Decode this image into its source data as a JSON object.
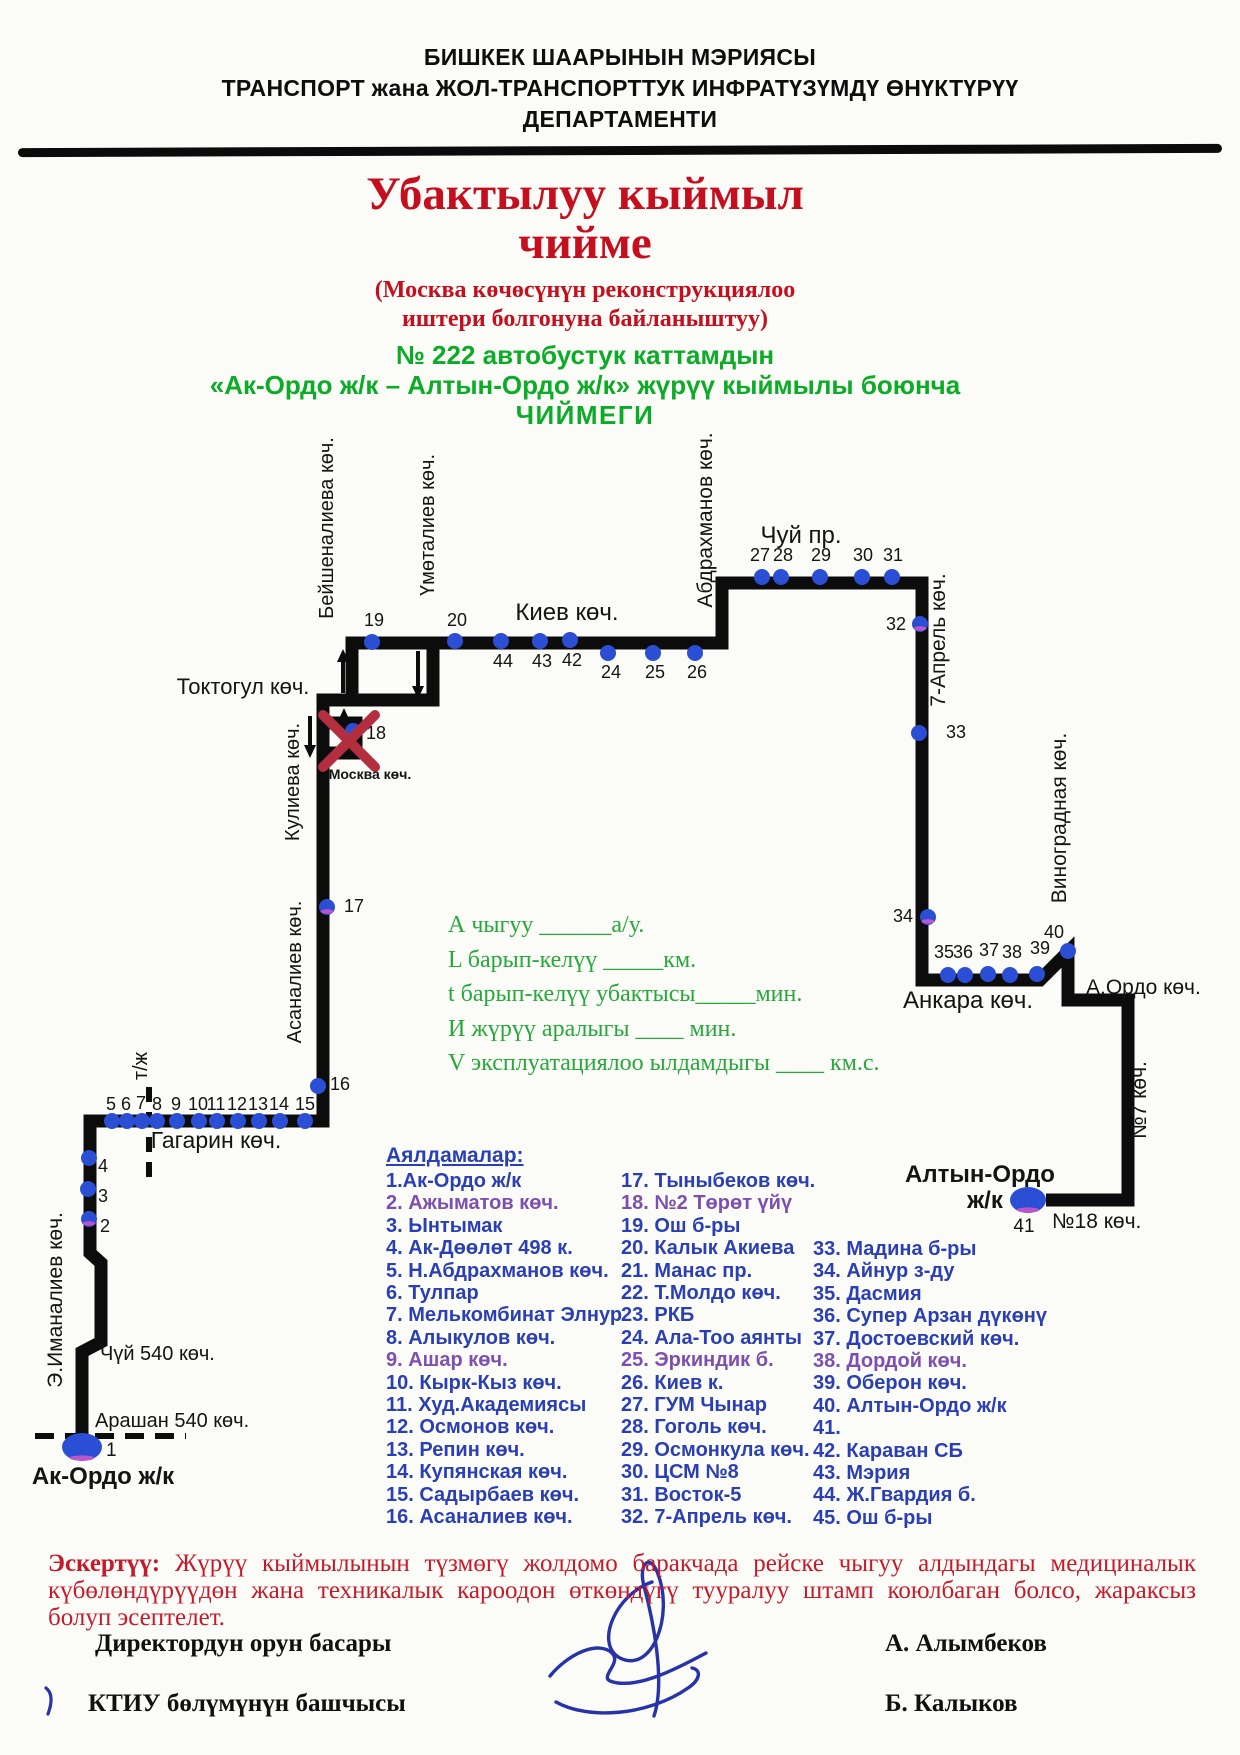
{
  "header": {
    "line1": "БИШКЕК ШААРЫНЫН МЭРИЯСЫ",
    "line2": "ТРАНСПОРТ жана ЖОЛ-ТРАНСПОРТТУК ИНФРАТҮЗҮМДҮ ӨНҮКТҮРҮҮ",
    "line3": "ДЕПАРТАМЕНТИ"
  },
  "title": {
    "line1": "Убактылуу кыймыл",
    "line2": "чийме",
    "sub1": "(Москва көчөсүнүн реконструкциялоо",
    "sub2": "иштери болгонуна байланыштуу)",
    "green1": "№ 222  автобустук каттамдын",
    "green2": "«Ак-Ордо  ж/к –  Алтын-Ордо ж/к» жүрүү кыймылы боюнча",
    "green3": "ЧИЙМЕГИ"
  },
  "params": {
    "lines": [
      "А чыгуу  ______а/у.",
      "L барып-келүү  _____км.",
      "t барып-келүү убактысы_____мин.",
      "И жүрүү аралыгы  ____   мин.",
      "V эксплуатациялоо ылдамдыгы  ____  км.с."
    ]
  },
  "stops_list": {
    "heading": "Аялдамалар:",
    "col1": [
      {
        "text": "1.Ак-Ордо ж/к"
      },
      {
        "text": "2. Ажыматов көч.",
        "tint": true
      },
      {
        "text": "3. Ынтымак"
      },
      {
        "text": "4. Ак-Дөөлөт 498 к."
      },
      {
        "text": "5. Н.Абдрахманов көч."
      },
      {
        "text": "6. Тулпар"
      },
      {
        "text": "7. Мелькомбинат Элнур"
      },
      {
        "text": "8. Алыкулов көч."
      },
      {
        "text": "9. Ашар көч.",
        "tint": true
      },
      {
        "text": "10. Кырк-Кыз көч."
      },
      {
        "text": "11. Худ.Академиясы"
      },
      {
        "text": "12. Осмонов көч."
      },
      {
        "text": "13. Репин көч."
      },
      {
        "text": "14. Купянская көч."
      },
      {
        "text": "15. Садырбаев көч."
      },
      {
        "text": "16. Асаналиев көч."
      }
    ],
    "col2": [
      {
        "text": "17. Тыныбеков көч."
      },
      {
        "text": "18. №2 Төрөт үйү",
        "tint": true
      },
      {
        "text": "19. Ош б-ры"
      },
      {
        "text": "20. Калык Акиева"
      },
      {
        "text": "21. Манас пр."
      },
      {
        "text": "22. Т.Молдо көч."
      },
      {
        "text": "23. РКБ"
      },
      {
        "text": "24. Ала-Тоо аянты"
      },
      {
        "text": "25. Эркиндик б.",
        "tint": true
      },
      {
        "text": "26. Киев к."
      },
      {
        "text": "27. ГУМ Чынар"
      },
      {
        "text": "28. Гоголь көч."
      },
      {
        "text": "29. Осмонкула көч."
      },
      {
        "text": "30. ЦСМ №8"
      },
      {
        "text": "31. Восток-5"
      },
      {
        "text": "32. 7-Апрель көч."
      }
    ],
    "col3": [
      {
        "text": "33. Мадина б-ры"
      },
      {
        "text": "34. Айнур з-ду"
      },
      {
        "text": "35. Дасмия"
      },
      {
        "text": "36. Супер Арзан дүкөнү"
      },
      {
        "text": "37. Достоевский көч."
      },
      {
        "text": "38. Дордой көч.",
        "tint": true
      },
      {
        "text": "39. Оберон көч."
      },
      {
        "text": "40. Алтын-Ордо ж/к"
      },
      {
        "text": "41."
      },
      {
        "text": "42. Караван СБ"
      },
      {
        "text": "43. Мэрия"
      },
      {
        "text": "44. Ж.Гвардия б."
      },
      {
        "text": "45. Ош б-ры"
      }
    ]
  },
  "note": {
    "bold": "Эскертүү:",
    "text": " Жүрүү кыймылынын түзмөгү жолдомо баракчада рейске чыгуу алдындагы медициналык күбөлөндүрүүдөн жана техникалык кароодон өткөндүгү тууралуу штамп коюлбаган болсо, жараксыз болуп эсептелет."
  },
  "signatures": {
    "left1": "Директордун орун басары",
    "right1": "А. Алымбеков",
    "left2": "КТИУ  бөлүмүнүн башчысы",
    "right2": "Б. Калыков"
  },
  "colors": {
    "line": "#0c0c0c",
    "dot": "#2b4fd4",
    "accent": "#bb55cc",
    "red_x": "#b32f3f",
    "map_text": "#141414",
    "title_red": "#c50f1f",
    "green": "#0cab28",
    "param_green": "#27a83b",
    "list_blue": "#2b3fb5",
    "tint_purple": "#7d4fb0",
    "note_red": "#c61a2b",
    "sig_blue": "#2733a8",
    "page_bg": "#fbfbf7"
  },
  "map": {
    "route": [
      "M 82 1437 V 1352 L 101 1342 V 1263 L 90 1253 V 1121 H 323 V 700 H 352 V 643 H 722 V 583 H 922 V 980 H 1040 L 1068 952 V 1000 H 1128 V 1200 H 1046",
      "M 352 643 H 433 V 700 H 352 Z",
      "M 323 723 H 356 V 753 H 323 Z"
    ],
    "dashed": [
      {
        "x1": 35,
        "y1": 1436,
        "x2": 186,
        "y2": 1436,
        "dash": "19 11",
        "name": "arashan-dashed-line"
      },
      {
        "x1": 149,
        "y1": 1087,
        "x2": 149,
        "y2": 1180,
        "dash": "15 10",
        "name": "railway-dashed-line"
      }
    ],
    "arrows": [
      {
        "x": 343,
        "y1": 693,
        "y2": 649
      },
      {
        "x": 418,
        "y1": 651,
        "y2": 699
      },
      {
        "x": 310,
        "y1": 716,
        "y2": 758
      },
      {
        "x": 344,
        "y1": 752,
        "y2": 708
      }
    ],
    "red_x": {
      "x1a": 323,
      "y1a": 715,
      "x2a": 375,
      "y2a": 767,
      "x1b": 375,
      "y1b": 715,
      "x2b": 323,
      "y2b": 767
    },
    "terminals": [
      {
        "n": "1",
        "x": 82,
        "y": 1447,
        "rx": 20,
        "ry": 14,
        "lx": 106,
        "ly": 1456,
        "a": "start"
      },
      {
        "n": "41",
        "x": 1028,
        "y": 1200,
        "rx": 18,
        "ry": 13,
        "lx": 1024,
        "ly": 1232,
        "a": "middle"
      }
    ],
    "stops": [
      {
        "n": "2",
        "x": 89,
        "y": 1219,
        "lx": 100,
        "ly": 1232,
        "a": "start",
        "tint": true
      },
      {
        "n": "3",
        "x": 88,
        "y": 1189,
        "lx": 98,
        "ly": 1202,
        "a": "start"
      },
      {
        "n": "4",
        "x": 89,
        "y": 1158,
        "lx": 98,
        "ly": 1172,
        "a": "start"
      },
      {
        "n": "5",
        "x": 112,
        "y": 1121,
        "lx": 111,
        "ly": 1110
      },
      {
        "n": "6",
        "x": 127,
        "y": 1121,
        "lx": 126,
        "ly": 1110
      },
      {
        "n": "7",
        "x": 142,
        "y": 1121,
        "lx": 141,
        "ly": 1109
      },
      {
        "n": "8",
        "x": 157,
        "y": 1121,
        "lx": 157,
        "ly": 1110
      },
      {
        "n": "9",
        "x": 177,
        "y": 1121,
        "lx": 176,
        "ly": 1110
      },
      {
        "n": "10",
        "x": 199,
        "y": 1121,
        "lx": 198,
        "ly": 1110
      },
      {
        "n": "11",
        "x": 217,
        "y": 1121,
        "lx": 216,
        "ly": 1110
      },
      {
        "n": "12",
        "x": 238,
        "y": 1121,
        "lx": 237,
        "ly": 1110
      },
      {
        "n": "13",
        "x": 259,
        "y": 1121,
        "lx": 258,
        "ly": 1110
      },
      {
        "n": "14",
        "x": 280,
        "y": 1121,
        "lx": 279,
        "ly": 1110
      },
      {
        "n": "15",
        "x": 305,
        "y": 1121,
        "lx": 305,
        "ly": 1110
      },
      {
        "n": "16",
        "x": 318,
        "y": 1086,
        "lx": 330,
        "ly": 1090,
        "a": "start"
      },
      {
        "n": "17",
        "x": 327,
        "y": 907,
        "lx": 344,
        "ly": 912,
        "a": "start",
        "tint": true
      },
      {
        "n": "18",
        "x": 353,
        "y": 731,
        "lx": 366,
        "ly": 739,
        "a": "start"
      },
      {
        "n": "19",
        "x": 372,
        "y": 642,
        "lx": 374,
        "ly": 626
      },
      {
        "n": "20",
        "x": 455,
        "y": 641,
        "lx": 457,
        "ly": 626
      },
      {
        "n": "44",
        "x": 501,
        "y": 641,
        "lx": 503,
        "ly": 667
      },
      {
        "n": "43",
        "x": 540,
        "y": 641,
        "lx": 542,
        "ly": 667
      },
      {
        "n": "42",
        "x": 570,
        "y": 640,
        "lx": 572,
        "ly": 666
      },
      {
        "n": "24",
        "x": 608,
        "y": 653,
        "lx": 611,
        "ly": 678
      },
      {
        "n": "25",
        "x": 653,
        "y": 653,
        "lx": 655,
        "ly": 678
      },
      {
        "n": "26",
        "x": 695,
        "y": 653,
        "lx": 697,
        "ly": 678
      },
      {
        "n": "27",
        "x": 762,
        "y": 577,
        "lx": 760,
        "ly": 561
      },
      {
        "n": "28",
        "x": 781,
        "y": 577,
        "lx": 783,
        "ly": 561
      },
      {
        "n": "29",
        "x": 820,
        "y": 577,
        "lx": 821,
        "ly": 561
      },
      {
        "n": "30",
        "x": 862,
        "y": 577,
        "lx": 863,
        "ly": 561
      },
      {
        "n": "31",
        "x": 892,
        "y": 577,
        "lx": 893,
        "ly": 561
      },
      {
        "n": "32",
        "x": 920,
        "y": 624,
        "lx": 906,
        "ly": 630,
        "a": "end",
        "tint": true
      },
      {
        "n": "33",
        "x": 919,
        "y": 733,
        "lx": 946,
        "ly": 738,
        "a": "start"
      },
      {
        "n": "34",
        "x": 928,
        "y": 917,
        "lx": 913,
        "ly": 922,
        "a": "end",
        "tint": true
      },
      {
        "n": "35",
        "x": 948,
        "y": 975,
        "lx": 944,
        "ly": 958
      },
      {
        "n": "36",
        "x": 965,
        "y": 975,
        "lx": 963,
        "ly": 958
      },
      {
        "n": "37",
        "x": 988,
        "y": 974,
        "lx": 989,
        "ly": 956
      },
      {
        "n": "38",
        "x": 1010,
        "y": 975,
        "lx": 1012,
        "ly": 958
      },
      {
        "n": "39",
        "x": 1037,
        "y": 974,
        "lx": 1040,
        "ly": 954
      },
      {
        "n": "40",
        "x": 1068,
        "y": 951,
        "lx": 1054,
        "ly": 938
      }
    ],
    "labels": [
      {
        "text": "Бейшеналиева көч.",
        "x": 333,
        "y": 528,
        "r": -90
      },
      {
        "text": "Үмөталиев  көч.",
        "x": 434,
        "y": 525,
        "r": -90
      },
      {
        "text": "Токтогул көч.",
        "x": 243,
        "y": 694,
        "s": 22
      },
      {
        "text": "Кулиева көч.",
        "x": 299,
        "y": 782,
        "r": -90
      },
      {
        "text": "Асаналиев  көч.",
        "x": 301,
        "y": 972,
        "r": -90
      },
      {
        "text": "Киев көч.",
        "x": 567,
        "y": 620,
        "s": 24
      },
      {
        "text": "Абдрахманов көч.",
        "x": 712,
        "y": 520,
        "r": -90,
        "s": 21
      },
      {
        "text": "Чуй пр.",
        "x": 801,
        "y": 543,
        "s": 24
      },
      {
        "text": "7-Апрель көч.",
        "x": 945,
        "y": 640,
        "r": -90,
        "s": 21
      },
      {
        "text": "Виноградная көч.",
        "x": 1066,
        "y": 818,
        "r": -90,
        "s": 21
      },
      {
        "text": "Анкара көч.",
        "x": 968,
        "y": 1008,
        "s": 24
      },
      {
        "text": "А.Ордо көч.",
        "x": 1086,
        "y": 994,
        "a": "start",
        "s": 21
      },
      {
        "text": "№7 көч.",
        "x": 1146,
        "y": 1100,
        "r": -90,
        "s": 21
      },
      {
        "text": "№18 көч.",
        "x": 1052,
        "y": 1228,
        "a": "start",
        "s": 21
      },
      {
        "text": "Москва көч.",
        "x": 370,
        "y": 779,
        "s": 14,
        "b": true
      },
      {
        "text": "Гагарин көч.",
        "x": 216,
        "y": 1148,
        "s": 23
      },
      {
        "text": "т/ж",
        "x": 147,
        "y": 1066,
        "r": -90,
        "s": 20
      },
      {
        "text": "Чүй 540 көч.",
        "x": 100,
        "y": 1360,
        "a": "start",
        "s": 20
      },
      {
        "text": "Арашан 540 көч.",
        "x": 95,
        "y": 1427,
        "a": "start",
        "s": 20
      },
      {
        "text": "Э.Иманалиев көч.",
        "x": 62,
        "y": 1300,
        "r": -90,
        "s": 21
      },
      {
        "text": "Ак-Ордо  ж/к",
        "x": 103,
        "y": 1484,
        "s": 24,
        "b": true
      },
      {
        "text": "Алтын-Ордо",
        "x": 980,
        "y": 1182,
        "s": 24,
        "b": true
      },
      {
        "text": "ж/к",
        "x": 985,
        "y": 1208,
        "s": 24,
        "b": true
      }
    ]
  }
}
